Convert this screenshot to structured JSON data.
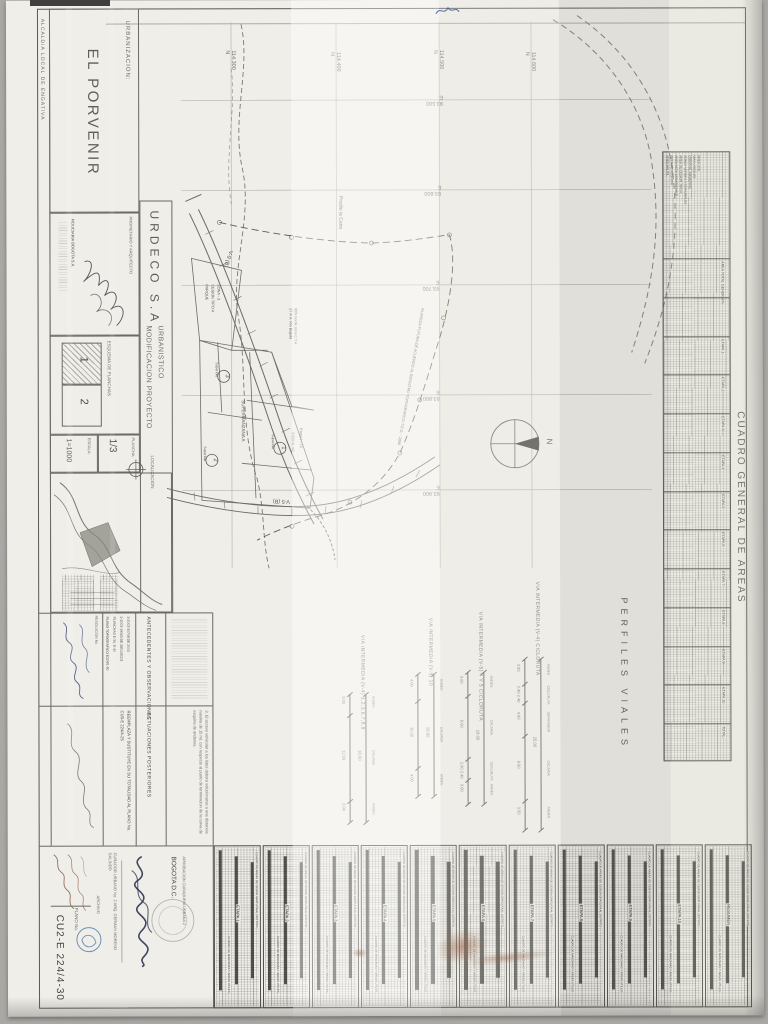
{
  "title_block": {
    "alcaldia": "ALCALDIA LOCAL DE ENGATIVA",
    "urbanizacion_label": "URBANIZACION:",
    "project_name": "EL PORVENIR",
    "propietario_label": "PROPIETARIO Y ARQUITECTO",
    "owner": "FIDUCIARIA BOGOTA S.A.",
    "company": "URDECO S.A.",
    "subtitle_1": "MODIFICACION PROYECTO",
    "subtitle_2": "URBANISTICO",
    "localizacion_label": "LOCALIZACION",
    "esquema_label": "ESQUEMA DE PLANCHAS",
    "esquema_sheet_1": "1",
    "esquema_sheet_2": "2",
    "plancha_label": "PLANCHA:",
    "plancha_value": "1/3",
    "escala_label": "ESCALA:",
    "escala_value": "1=1000",
    "loc_map_label": "URB. PARQUES DE GRANADA",
    "loc_map_river": "Rio Bogota",
    "antecedentes_label": "ANTECEDENTES Y OBSERVACIONES",
    "antecedentes_lines": [
      "PLANO TOPOGRAFICO E224/1-90",
      "PLANCHAS E-36, E-40",
      "2-2003-19063 DE 28/10/2003",
      "3-2003-30708 DE 2003"
    ],
    "resolucion_label": "RESOLUCION No.",
    "actuaciones_label": "ACTUACIONES POSTERIORES",
    "actuaciones_text": "REEMPLAZA Y SUSTITUYE EN SU TOTALIDAD AL PLANO No. CU3-E 224/4-25",
    "nota_text": "3. El acceso vehicular a los lotes debera solucionarse a una distancia minima de 15 mt. con respecto al punto de terminacion de la curva de esquina de andenes.",
    "bogota": "BOGOTA D.C.",
    "aprobacion": "APROBACION CURADURIA URBANA 2",
    "curador": "CURADOR URBANO No. 2  ARQ. GERMAN MORENO GALINDO",
    "archivo_label": "ARCHIVO",
    "plano_no_label": "PLANO No.",
    "plano_no_value": "CU2-E 224/4-30"
  },
  "map": {
    "grid_n_labels": [
      "114.300 N",
      "114.400 N",
      "114.500 N",
      "114.600 N"
    ],
    "grid_e_labels": [
      "93.500 E",
      "93.600 E",
      "93.700 E",
      "93.800 E",
      "93.900 E"
    ],
    "road_label_1": "V-9 (B)",
    "road_label_2": "V-5 (B)",
    "supermanzana": "SUPERMANZANA A",
    "parcels": [
      {
        "num": "1",
        "sub": "Superlote",
        "area": "3.543,41 m2"
      },
      {
        "num": "2",
        "sub": "Superlote",
        "area": ""
      },
      {
        "num": "3",
        "sub": "Superlote",
        "area": ""
      }
    ],
    "etapa_tag": "Etapa I - 10",
    "park_lines": [
      "PARQUE",
      "CESION TIPO A",
      "ZONA - 3"
    ],
    "alameda_note": "ALAMEDA FUTURA DE ACUERDO AL REGISTRO TOPOGRAFICO T.D.G. - 2886",
    "predio_label": "Predio la Cano",
    "rio_notes": [
      "27 m A. Rio Bogota",
      "60% borde zona C.T.A."
    ],
    "compass_n": "N"
  },
  "perfiles": {
    "title": "PERFILES VIALES",
    "profiles": [
      {
        "name": "VIA INTERMEDIA (V-4)  1,2,3,6,7,8,9",
        "dims": [
          "3.00",
          "12.00",
          "3.00"
        ],
        "total": "18.00",
        "parts": [
          "ANDEN",
          "CALZADA",
          "ANDEN"
        ]
      },
      {
        "name": "VIA INTERMEDIA (V-5)  10",
        "dims": [
          "4.00",
          "10.00",
          "4.00"
        ],
        "total": "18.00",
        "parts": [
          "ANDEN",
          "CALZADA",
          "ANDEN"
        ]
      },
      {
        "name": "VIA INTERMEDIA (V-5)  4 Y 5  CICLORUTA",
        "dims": [
          "3.00",
          "8.00",
          "2.60 2.40",
          "3.00"
        ],
        "total": "18.00",
        "parts": [
          "ANDEN",
          "CALZADA",
          "CICLORUTA",
          "ANDEN"
        ]
      },
      {
        "name": "VIA INTERMEDIA (V-4)  CICLORUTA",
        "dims": [
          "3.00",
          "2.40 2.40",
          "4.00",
          "8.00",
          "3.50"
        ],
        "total": "25.00",
        "parts": [
          "ANDEN",
          "CICLORUTA",
          "SEPARADOR",
          "CALZADA",
          "ANDEN"
        ]
      }
    ]
  },
  "cuadro_general": {
    "title": "CUADRO GENERAL DE AREAS",
    "row_labels": [
      "AREA BRUTA",
      "AREA DE RESERVA",
      "AREA NETA URBANIZABLE",
      "AREA DE CESION TIPO A",
      "ZONAS VERDES Y COMUNALES",
      "CONTROL AMBIENTAL",
      "VIAS LOCALES",
      "AREA UTIL"
    ],
    "bands": [
      "AREA TOTAL GENERAL",
      "%",
      "ETAPA 1",
      "ETAPA 2",
      "ETAPA 3",
      "ETAPA 4",
      "ETAPA 5",
      "ETAPA 6",
      "ETAPA 7",
      "ETAPA 8",
      "ETAPA 9",
      "ETAPA 10",
      "TOTAL"
    ]
  },
  "bottom_tables": {
    "caption_a": "CUADRO DE AREAS DE CESION GRATUITA AL DISTRITO",
    "caption_b": "CUADRO DE MANZANAS Y AREAS UTILES",
    "etapas": [
      "ETAPA 1",
      "ETAPA 2",
      "ETAPA 3",
      "ETAPA 4",
      "ETAPA 5",
      "ETAPA 6",
      "ETAPA 7",
      "ETAPA 8",
      "ETAPA 9",
      "ETAPA 10",
      "RESUMEN"
    ]
  },
  "colors": {
    "paper": "#efeee8",
    "ink": "#4b4a45",
    "drawing_line": "#6a6962",
    "hand_blue": "#31427c",
    "hand_red": "#7a3b2e",
    "stain_rust": "#9a6248"
  }
}
